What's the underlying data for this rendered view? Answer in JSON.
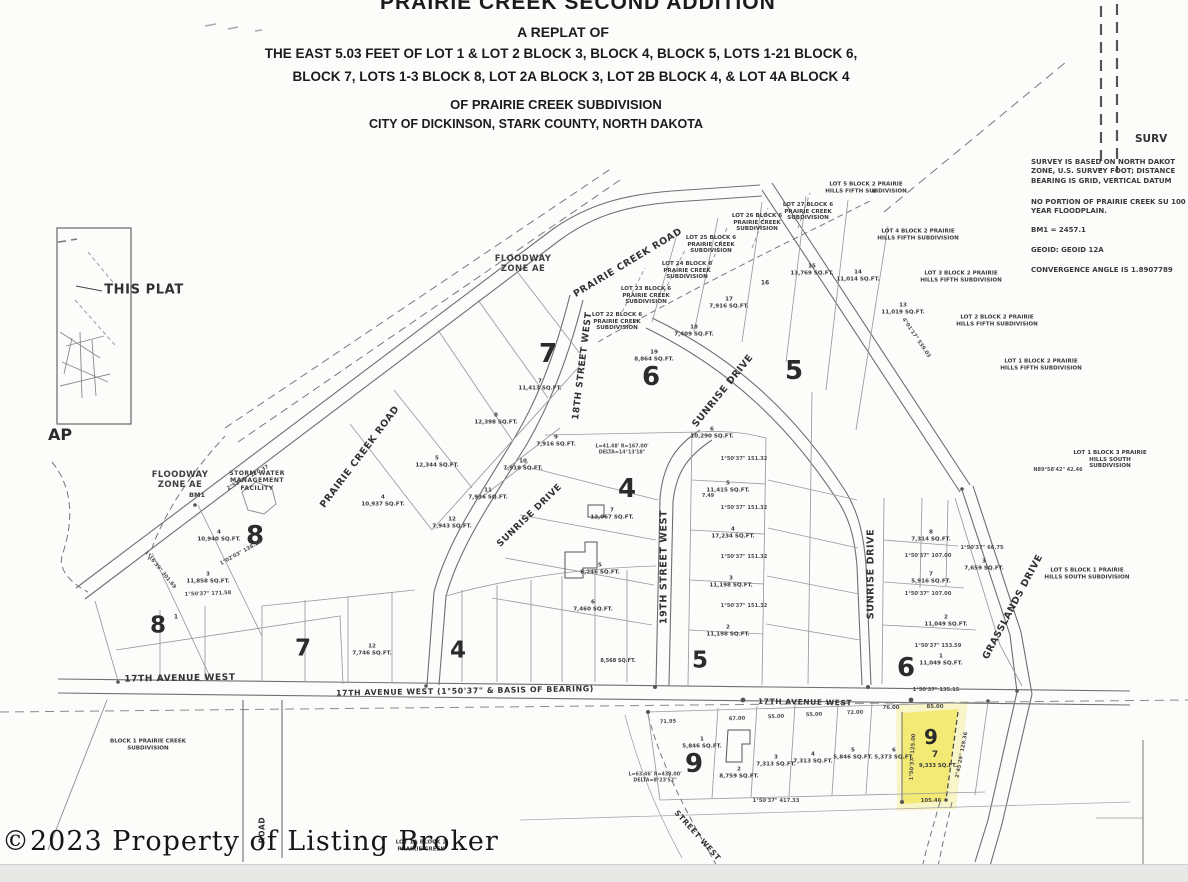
{
  "title_block": {
    "line1": "PRAIRIE CREEK SECOND ADDITION",
    "line2": "A REPLAT OF",
    "line3": "THE EAST 5.03 FEET OF LOT 1 & LOT 2 BLOCK 3, BLOCK 4, BLOCK 5, LOTS 1-21 BLOCK 6,",
    "line4": "BLOCK 7,  LOTS 1-3 BLOCK 8, LOT 2A BLOCK 3, LOT 2B BLOCK 4, & LOT 4A BLOCK 4",
    "line5": "OF PRAIRIE CREEK SUBDIVISION",
    "line6": "CITY OF DICKINSON, STARK COUNTY, NORTH DAKOTA"
  },
  "notes_panel": {
    "heading_fragment": "SURV",
    "note_datum": "SURVEY IS BASED ON NORTH DAKOT ZONE, U.S. SURVEY FOOT; DISTANCE BEARING IS GRID,  VERTICAL DATUM",
    "note_floodplain": "NO PORTION OF PRAIRIE CREEK SU 100 YEAR FLOODPLAIN.",
    "note_bm1": "BM1 = 2457.1",
    "note_geoid": "GEOID: GEOID 12A",
    "note_convergence": "CONVERGENCE ANGLE IS 1.8907789"
  },
  "watermark": {
    "text": "©2023 Property of Listing Broker"
  },
  "highlighted_lot": {
    "block": "9",
    "lot": "7",
    "area_sqft": "9,333 SQ.FT.",
    "color": "#f2e96d"
  },
  "colors": {
    "paper": "#fcfcfb",
    "ink": "#3b3b3b",
    "line_gray": "#8f8f8f"
  },
  "map_labels": [
    {
      "n": "street-prairie-creek-road-upper",
      "t": "PRAIRIE CREEK ROAD",
      "x": 628,
      "y": 263,
      "r": -31,
      "fs": 9.5,
      "cls": "street"
    },
    {
      "n": "street-prairie-creek-road-lower",
      "t": "PRAIRIE CREEK ROAD",
      "x": 360,
      "y": 457,
      "r": -53,
      "fs": 9.5,
      "cls": "street"
    },
    {
      "n": "street-sunrise-drive-upper",
      "t": "SUNRISE DRIVE",
      "x": 723,
      "y": 391,
      "r": -51,
      "fs": 9.5,
      "cls": "street"
    },
    {
      "n": "street-sunrise-drive-mid",
      "t": "SUNRISE DRIVE",
      "x": 530,
      "y": 516,
      "r": -44,
      "fs": 9,
      "cls": "street"
    },
    {
      "n": "street-sunrise-drive-south",
      "t": "SUNRISE DRIVE",
      "x": 871,
      "y": 574,
      "r": -90,
      "fs": 9.5,
      "cls": "street"
    },
    {
      "n": "street-18th-street-west",
      "t": "18TH STREET WEST",
      "x": 583,
      "y": 366,
      "r": -83,
      "fs": 9,
      "cls": "street"
    },
    {
      "n": "street-19th-street-west",
      "t": "19TH STREET WEST",
      "x": 664,
      "y": 567,
      "r": -90,
      "fs": 9.5,
      "cls": "street"
    },
    {
      "n": "street-grasslands-drive",
      "t": "GRASSLANDS DRIVE",
      "x": 1013,
      "y": 607,
      "r": -62,
      "fs": 9.5,
      "cls": "street"
    },
    {
      "n": "street-17th-avenue-west-left",
      "t": "17TH AVENUE WEST",
      "x": 180,
      "y": 679,
      "r": -1,
      "fs": 9,
      "cls": "street"
    },
    {
      "n": "street-17th-avenue-west-center",
      "t": "17TH AVENUE WEST (1°50'37\" & BASIS OF BEARING)",
      "x": 465,
      "y": 691,
      "r": -1,
      "fs": 7.8,
      "cls": "street"
    },
    {
      "n": "street-17th-avenue-west-right",
      "t": "17TH AVENUE WEST",
      "x": 805,
      "y": 703,
      "r": 1,
      "fs": 7.5,
      "cls": "street"
    },
    {
      "n": "street-road-fragment",
      "t": "ROAD",
      "x": 263,
      "y": 830,
      "r": -90,
      "fs": 7.5,
      "cls": "street"
    },
    {
      "n": "street-street-west-fragment",
      "t": "STREET WEST",
      "x": 697,
      "y": 836,
      "r": 48,
      "fs": 7.5,
      "cls": "street"
    },
    {
      "n": "zone-floodway-upper",
      "t": "FLOODWAY\nZONE AE",
      "x": 523,
      "y": 264,
      "fs": 8.5,
      "cls": "zone"
    },
    {
      "n": "zone-floodway-left",
      "t": "FLOODWAY\nZONE AE",
      "x": 180,
      "y": 480,
      "fs": 8.5,
      "cls": "zone"
    },
    {
      "n": "storm-water-facility-label",
      "t": "STORM WATER\nMANAGEMENT\nFACILITY",
      "x": 257,
      "y": 481,
      "fs": 6.2,
      "cls": "zone"
    },
    {
      "n": "bm1-label",
      "t": "BM1",
      "x": 197,
      "y": 496,
      "fs": 6.5
    },
    {
      "n": "this-plat-label",
      "t": "THIS PLAT",
      "x": 144,
      "y": 290,
      "fs": 13,
      "cls": "street"
    },
    {
      "n": "vicinity-caption-fragment",
      "t": "AP",
      "x": 60,
      "y": 435,
      "fs": 16,
      "cls": "big"
    },
    {
      "n": "block-8-upper-numeral",
      "t": "8",
      "x": 255,
      "y": 536,
      "fs": 26,
      "cls": "big"
    },
    {
      "n": "block-8-lower-numeral",
      "t": "8",
      "x": 158,
      "y": 626,
      "fs": 23,
      "cls": "big"
    },
    {
      "n": "block-7-upper-numeral",
      "t": "7",
      "x": 548,
      "y": 354,
      "fs": 26,
      "cls": "big"
    },
    {
      "n": "block-7-lower-numeral",
      "t": "7",
      "x": 303,
      "y": 649,
      "fs": 23,
      "cls": "big"
    },
    {
      "n": "block-6-upper-numeral",
      "t": "6",
      "x": 651,
      "y": 377,
      "fs": 26,
      "cls": "big"
    },
    {
      "n": "block-6-lower-numeral",
      "t": "6",
      "x": 906,
      "y": 668,
      "fs": 26,
      "cls": "big"
    },
    {
      "n": "block-5-upper-numeral",
      "t": "5",
      "x": 794,
      "y": 371,
      "fs": 26,
      "cls": "big"
    },
    {
      "n": "block-5-lower-numeral",
      "t": "5",
      "x": 700,
      "y": 661,
      "fs": 23,
      "cls": "big"
    },
    {
      "n": "block-4-upper-numeral",
      "t": "4",
      "x": 627,
      "y": 489,
      "fs": 26,
      "cls": "big"
    },
    {
      "n": "block-4-lower-numeral",
      "t": "4",
      "x": 458,
      "y": 651,
      "fs": 23,
      "cls": "big"
    },
    {
      "n": "block-9-west-numeral",
      "t": "9",
      "x": 694,
      "y": 764,
      "fs": 26,
      "cls": "big"
    },
    {
      "n": "adj-lot-22-block-6",
      "t": "LOT 22 BLOCK 6\nPRAIRIE CREEK\nSUBDIVISION",
      "x": 617,
      "y": 322
    },
    {
      "n": "adj-lot-23-block-6",
      "t": "LOT 23 BLOCK 6\nPRAIRIE CREEK\nSUBDIVISION",
      "x": 646,
      "y": 296
    },
    {
      "n": "adj-lot-24-block-6",
      "t": "LOT 24 BLOCK 6\nPRAIRIE CREEK\nSUBDIVISION",
      "x": 687,
      "y": 271
    },
    {
      "n": "adj-lot-25-block-6",
      "t": "LOT 25 BLOCK 6\nPRAIRIE CREEK\nSUBDIVISION",
      "x": 711,
      "y": 245
    },
    {
      "n": "adj-lot-26-block-6",
      "t": "LOT 26 BLOCK 6\nPRAIRIE CREEK\nSUBDIVISION",
      "x": 757,
      "y": 223
    },
    {
      "n": "adj-lot-27-block-6",
      "t": "LOT 27 BLOCK 6\nPRAIRIE CREEK\nSUBDIVISION",
      "x": 808,
      "y": 212
    },
    {
      "n": "adj-lot-5-block-2-ph5",
      "t": "LOT 5 BLOCK 2 PRAIRIE\nHILLS FIFTH SUBDIVISION",
      "x": 866,
      "y": 188
    },
    {
      "n": "adj-lot-4-block-2-ph5",
      "t": "LOT 4 BLOCK 2 PRAIRIE\nHILLS FIFTH SUBDIVISION",
      "x": 918,
      "y": 235
    },
    {
      "n": "adj-lot-3-block-2-ph5",
      "t": "LOT 3 BLOCK 2 PRAIRIE\nHILLS FIFTH SUBDIVISION",
      "x": 961,
      "y": 277
    },
    {
      "n": "adj-lot-2-block-2-ph5",
      "t": "LOT 2 BLOCK 2 PRAIRIE\nHILLS FIFTH SUBDIVISION",
      "x": 997,
      "y": 321
    },
    {
      "n": "adj-lot-1-block-2-ph5",
      "t": "LOT 1 BLOCK 2 PRAIRIE\nHILLS FIFTH SUBDIVISION",
      "x": 1041,
      "y": 365
    },
    {
      "n": "adj-lot-1-block-3-phs",
      "t": "LOT 1 BLOCK 3 PRAIRIE\nHILLS SOUTH SUBDIVISION",
      "x": 1110,
      "y": 460
    },
    {
      "n": "adj-lot-5-block-1-phs",
      "t": "LOT 5 BLOCK 1 PRAIRIE\nHILLS SOUTH SUBDIVISION",
      "x": 1087,
      "y": 574
    },
    {
      "n": "adj-block-1-pcs",
      "t": "BLOCK 1 PRAIRIE CREEK\nSUBDIVISION",
      "x": 148,
      "y": 745
    },
    {
      "n": "adj-lot-1a-block-2-pcs",
      "t": "LOT 1A BLOCK 2\nPRAIRIE CREEK",
      "x": 421,
      "y": 846
    },
    {
      "n": "lot-b8-4",
      "t": "4\n10,940 SQ.FT.",
      "x": 219,
      "y": 536
    },
    {
      "n": "lot-b8-3",
      "t": "3\n11,858 SQ.FT.",
      "x": 208,
      "y": 578
    },
    {
      "n": "lot-b8-1",
      "t": "1",
      "x": 176,
      "y": 617,
      "fs": 6
    },
    {
      "n": "lot-b7-7",
      "t": "7\n11,413 SQ.FT.",
      "x": 540,
      "y": 385
    },
    {
      "n": "lot-b7-8",
      "t": "8\n12,398 SQ.FT.",
      "x": 496,
      "y": 419
    },
    {
      "n": "lot-b7-5",
      "t": "5\n12,344 SQ.FT.",
      "x": 437,
      "y": 462
    },
    {
      "n": "lot-b7-4",
      "t": "4\n10,937 SQ.FT.",
      "x": 383,
      "y": 501
    },
    {
      "n": "lot-b7-9",
      "t": "9\n7,916 SQ.FT.",
      "x": 556,
      "y": 441
    },
    {
      "n": "lot-b7-10",
      "t": "10\n7,918 SQ.FT.",
      "x": 523,
      "y": 465
    },
    {
      "n": "lot-b7-11",
      "t": "11\n7,936 SQ.FT.",
      "x": 488,
      "y": 494
    },
    {
      "n": "lot-b7-12",
      "t": "12\n7,943 SQ.FT.",
      "x": 452,
      "y": 523
    },
    {
      "n": "lot-b4-7",
      "t": "7\n12,067 SQ.FT.",
      "x": 612,
      "y": 514
    },
    {
      "n": "lot-b4-5",
      "t": "5\n8,246 SQ.FT.",
      "x": 600,
      "y": 569
    },
    {
      "n": "lot-b4-6",
      "t": "6\n7,460 SQ.FT.",
      "x": 593,
      "y": 606
    },
    {
      "n": "lot-b6-19",
      "t": "19\n8,864 SQ.FT.",
      "x": 654,
      "y": 356
    },
    {
      "n": "lot-b6-18",
      "t": "18\n7,409 SQ.FT.",
      "x": 694,
      "y": 331
    },
    {
      "n": "lot-b6-17",
      "t": "17\n7,916 SQ.FT.",
      "x": 729,
      "y": 303
    },
    {
      "n": "lot-b6-16",
      "t": "16",
      "x": 765,
      "y": 283,
      "fs": 6
    },
    {
      "n": "lot-b6-15",
      "t": "15\n13,769 SQ.FT.",
      "x": 812,
      "y": 270
    },
    {
      "n": "lot-b6-14",
      "t": "14\n11,014 SQ.FT.",
      "x": 858,
      "y": 276
    },
    {
      "n": "lot-b6-13",
      "t": "13\n11,019 SQ.FT.",
      "x": 903,
      "y": 309
    },
    {
      "n": "lot-b5-6",
      "t": "6\n10,290 SQ.FT.",
      "x": 712,
      "y": 433
    },
    {
      "n": "lot-b5-5",
      "t": "5\n11,415 SQ.FT.",
      "x": 728,
      "y": 487
    },
    {
      "n": "lot-b5-4",
      "t": "4\n17,234 SQ.FT.",
      "x": 733,
      "y": 533
    },
    {
      "n": "lot-b5-3",
      "t": "3\n11,198 SQ.FT.",
      "x": 731,
      "y": 582
    },
    {
      "n": "lot-b5-2",
      "t": "2\n11,198 SQ.FT.",
      "x": 728,
      "y": 631
    },
    {
      "n": "lot-b6c-8",
      "t": "8\n7,314 SQ.FT.",
      "x": 931,
      "y": 536
    },
    {
      "n": "lot-b6c-7",
      "t": "7\n5,916 SQ.FT.",
      "x": 931,
      "y": 578
    },
    {
      "n": "lot-b6c-3",
      "t": "3\n7,659 SQ.FT.",
      "x": 984,
      "y": 565
    },
    {
      "n": "lot-b6c-2",
      "t": "2\n11,049 SQ.FT.",
      "x": 946,
      "y": 621
    },
    {
      "n": "lot-b6c-1",
      "t": "1\n11,049 SQ.FT.",
      "x": 941,
      "y": 660
    },
    {
      "n": "lot-b9-1",
      "t": "1\n5,846 SQ.FT.",
      "x": 702,
      "y": 743
    },
    {
      "n": "lot-b9-2",
      "t": "2\n8,759 SQ.FT.",
      "x": 739,
      "y": 773
    },
    {
      "n": "lot-b9-3",
      "t": "3\n7,313 SQ.FT.",
      "x": 776,
      "y": 761
    },
    {
      "n": "lot-b9-4",
      "t": "4\n7,313 SQ.FT.",
      "x": 813,
      "y": 758
    },
    {
      "n": "lot-b9-5",
      "t": "5\n5,846 SQ.FT.",
      "x": 853,
      "y": 754
    },
    {
      "n": "lot-b9-6",
      "t": "6\n5,373 SQ.FT.",
      "x": 894,
      "y": 754
    },
    {
      "n": "lot-b7l-12",
      "t": "12\n7,746 SQ.FT.",
      "x": 372,
      "y": 650
    },
    {
      "n": "lot-b4l-sqft",
      "t": "8,568 SQ.FT.",
      "x": 618,
      "y": 662,
      "fs": 5
    },
    {
      "n": "dim-b9-bottom",
      "t": "1°50'37\" 417.33",
      "x": 776,
      "y": 801,
      "cls": "dim",
      "fs": 5.2
    },
    {
      "n": "dim-b6-south",
      "t": "1°50'37\" 135.15",
      "x": 936,
      "y": 690,
      "cls": "dim",
      "fs": 5.2
    },
    {
      "n": "dim-hl-top",
      "t": "85.00",
      "x": 935,
      "y": 707,
      "cls": "dim",
      "fs": 5.4
    },
    {
      "n": "dim-hl-left-col",
      "t": "76.00",
      "x": 891,
      "y": 708,
      "cls": "dim",
      "fs": 5.4
    },
    {
      "n": "dim-hl-west",
      "t": "1°50'37\" 125.00",
      "x": 913,
      "y": 757,
      "r": -87,
      "cls": "dim",
      "fs": 5.2
    },
    {
      "n": "dim-hl-east",
      "t": "2°45'29\" 129.36",
      "x": 962,
      "y": 755,
      "r": -79,
      "cls": "dim",
      "fs": 5.2
    },
    {
      "n": "dim-hl-bottom",
      "t": "105.46",
      "x": 931,
      "y": 801,
      "cls": "dim",
      "fs": 5.4
    },
    {
      "n": "dim-b9-7195",
      "t": "71.95",
      "x": 668,
      "y": 722,
      "r": -2,
      "cls": "dim",
      "fs": 5.2
    },
    {
      "n": "dim-b9-6700",
      "t": "67.00",
      "x": 737,
      "y": 719,
      "r": -2,
      "cls": "dim",
      "fs": 5.2
    },
    {
      "n": "dim-b9-5500a",
      "t": "55.00",
      "x": 776,
      "y": 717,
      "r": -2,
      "cls": "dim",
      "fs": 5.2
    },
    {
      "n": "dim-b9-5500b",
      "t": "55.00",
      "x": 814,
      "y": 715,
      "r": -2,
      "cls": "dim",
      "fs": 5.2
    },
    {
      "n": "dim-b9-7200",
      "t": "72.00",
      "x": 855,
      "y": 713,
      "r": -2,
      "cls": "dim",
      "fs": 5.2
    },
    {
      "n": "dim-b5-151a",
      "t": "1°50'37\" 151.32",
      "x": 744,
      "y": 508,
      "cls": "dim",
      "fs": 5.2
    },
    {
      "n": "dim-b5-151b",
      "t": "1°50'37\" 151.32",
      "x": 744,
      "y": 557,
      "cls": "dim",
      "fs": 5.2
    },
    {
      "n": "dim-b5-151c",
      "t": "1°50'37\" 151.32",
      "x": 744,
      "y": 606,
      "cls": "dim",
      "fs": 5.2
    },
    {
      "n": "dim-b5-151d",
      "t": "1°50'37\" 151.32",
      "x": 744,
      "y": 459,
      "cls": "dim",
      "fs": 5.2
    },
    {
      "n": "dim-b6c-107a",
      "t": "1°50'37\" 107.00",
      "x": 928,
      "y": 556,
      "cls": "dim",
      "fs": 5.2
    },
    {
      "n": "dim-b6c-107b",
      "t": "1°50'37\" 107.00",
      "x": 928,
      "y": 594,
      "cls": "dim",
      "fs": 5.2
    },
    {
      "n": "dim-b6c-153",
      "t": "1°50'37\" 153.59",
      "x": 938,
      "y": 646,
      "cls": "dim",
      "fs": 5.2
    },
    {
      "n": "dim-b6c-66",
      "t": "1°50'37\" 66.75",
      "x": 982,
      "y": 548,
      "cls": "dim",
      "fs": 5.2
    },
    {
      "n": "dim-curve-19th",
      "t": "L=63.46' R=433.00'\nDELTA=8°23'52\"",
      "x": 655,
      "y": 778,
      "cls": "dim",
      "fs": 4.8
    },
    {
      "n": "dim-curve-mid",
      "t": "L=41.48' R=167.00'\nDELTA=14°13'18\"",
      "x": 622,
      "y": 450,
      "cls": "dim",
      "fs": 4.8
    },
    {
      "n": "dim-road-ne",
      "t": "4°01'17\" 539.03",
      "x": 916,
      "y": 338,
      "r": 56,
      "cls": "dim",
      "fs": 5.2
    },
    {
      "n": "dim-left-boundary",
      "t": "1°16'39\" 301.69",
      "x": 160,
      "y": 570,
      "r": 51,
      "cls": "dim",
      "fs": 5.2
    },
    {
      "n": "dim-b8-top",
      "t": "2°59'09\" 120.37",
      "x": 248,
      "y": 478,
      "r": -29,
      "cls": "dim",
      "fs": 5.2
    },
    {
      "n": "dim-b8-138",
      "t": "1°02'03\" 138.24",
      "x": 241,
      "y": 553,
      "r": -29,
      "cls": "dim",
      "fs": 5.2
    },
    {
      "n": "dim-b8-171",
      "t": "1°50'37\" 171.58",
      "x": 208,
      "y": 594,
      "r": -2,
      "cls": "dim",
      "fs": 5.2
    },
    {
      "n": "dim-ne-42",
      "t": "N89°58'42\" 42.46",
      "x": 1058,
      "y": 471,
      "cls": "dim",
      "fs": 5
    },
    {
      "n": "dim-749",
      "t": "7.49",
      "x": 708,
      "y": 497,
      "cls": "dim",
      "fs": 5
    }
  ]
}
